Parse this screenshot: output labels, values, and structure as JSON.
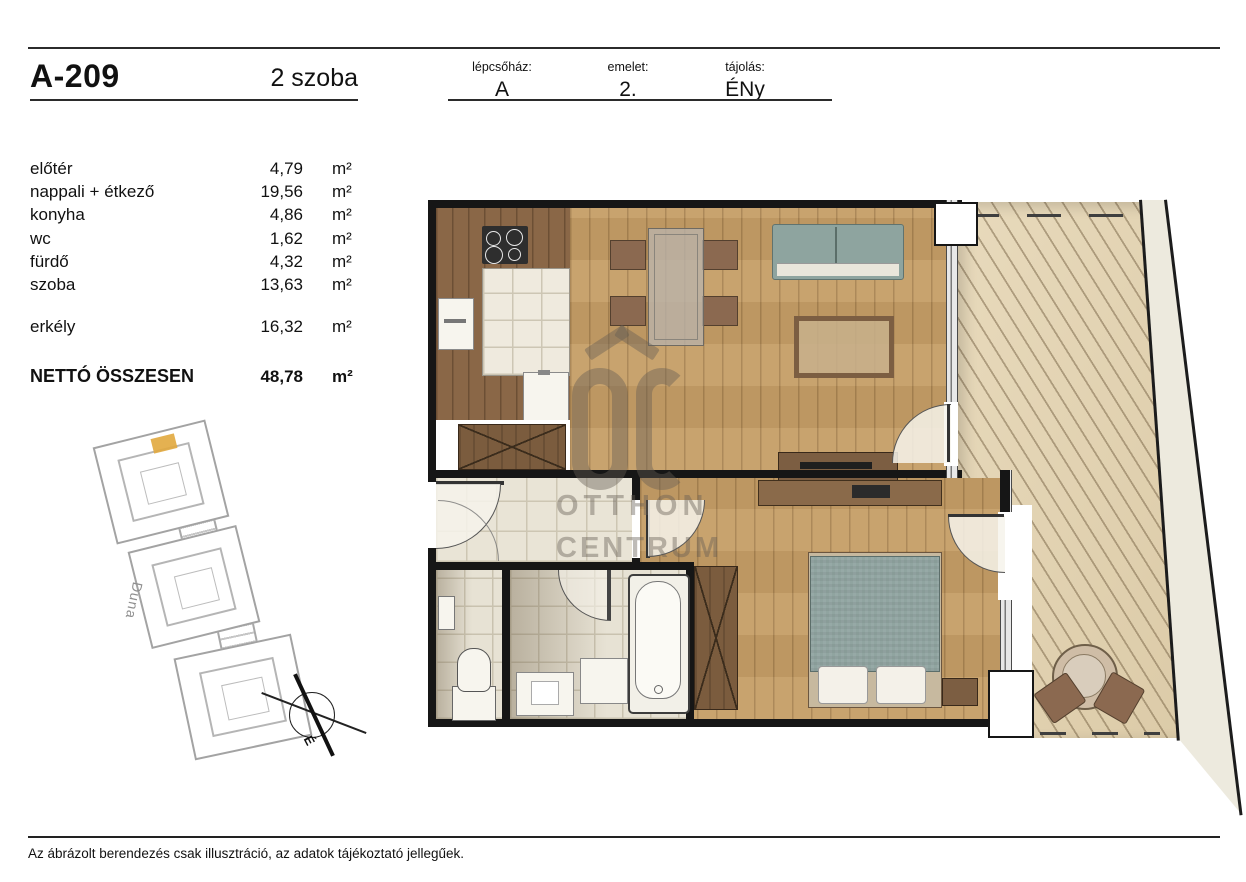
{
  "header": {
    "unit_id": "A-209",
    "unit_type": "2 szoba",
    "fields": [
      {
        "label": "lépcsőház:",
        "value": "A"
      },
      {
        "label": "emelet:",
        "value": "2."
      },
      {
        "label": "tájolás:",
        "value": "ÉNy"
      }
    ]
  },
  "area_table": {
    "rooms": [
      {
        "name": "előtér",
        "value": "4,79",
        "unit": "m²"
      },
      {
        "name": "nappali + étkező",
        "value": "19,56",
        "unit": "m²"
      },
      {
        "name": "konyha",
        "value": "4,86",
        "unit": "m²"
      },
      {
        "name": "wc",
        "value": "1,62",
        "unit": "m²"
      },
      {
        "name": "fürdő",
        "value": "4,32",
        "unit": "m²"
      },
      {
        "name": "szoba",
        "value": "13,63",
        "unit": "m²"
      }
    ],
    "balcony": {
      "name": "erkély",
      "value": "16,32",
      "unit": "m²"
    },
    "total": {
      "name": "NETTÓ ÖSSZESEN",
      "value": "48,78",
      "unit": "m²"
    }
  },
  "site_plan": {
    "river_label": "Duna",
    "compass_direction": "É",
    "highlight_color": "#e1a83e"
  },
  "watermark": {
    "line1": "OTTHON",
    "line2": "CENTRUM"
  },
  "footer": {
    "disclaimer": "Az ábrázolt berendezés csak illusztráció, az adatok tájékoztató jellegűek."
  },
  "colors": {
    "wood_floor": "#c59e66",
    "kitchen_floor": "#8a6747",
    "deck": "#e0d2b4",
    "tile": "#e9e4d6",
    "upholstery": "#8ea49f",
    "wall": "#161616",
    "site_outline": "#a3a3a3"
  }
}
